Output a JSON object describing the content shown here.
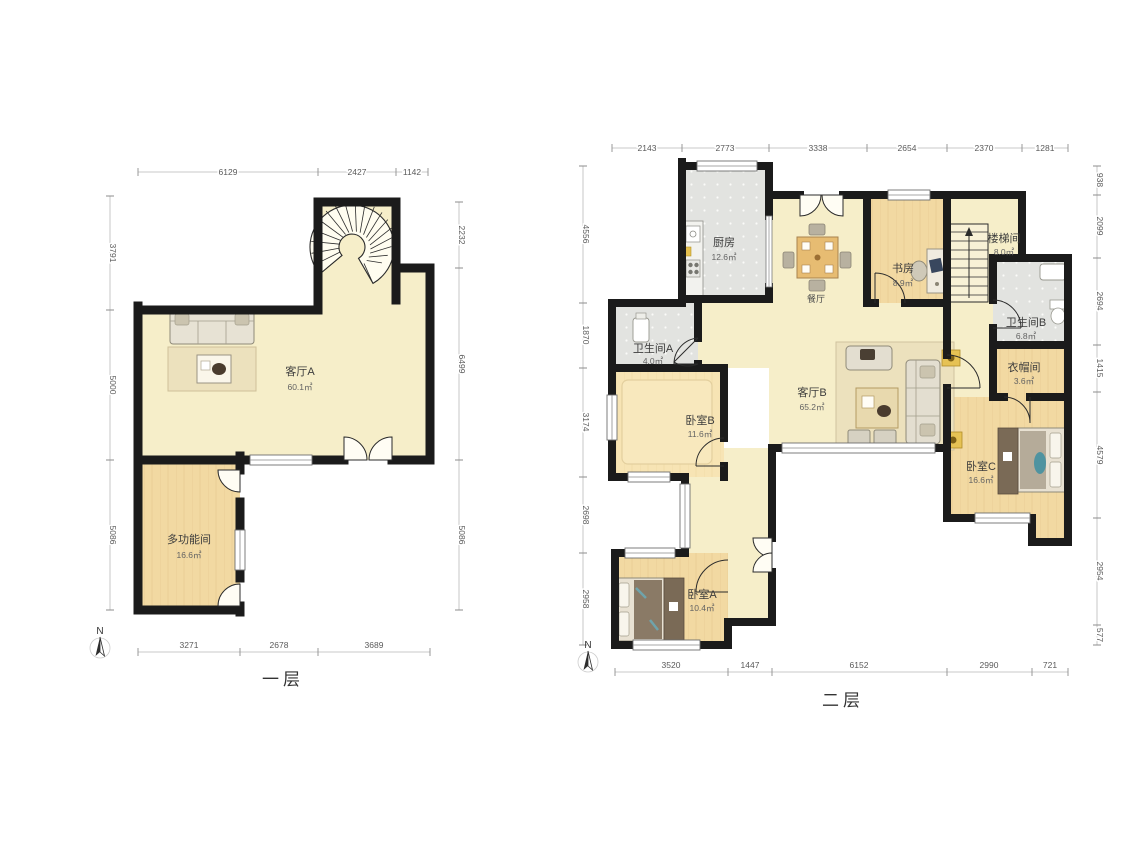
{
  "floor1": {
    "title": "一层",
    "north_label": "N",
    "rooms": {
      "living_a": {
        "name": "客厅A",
        "area": "60.1㎡"
      },
      "multi": {
        "name": "多功能间",
        "area": "16.6㎡"
      }
    },
    "dims": {
      "top": [
        "6129",
        "2427",
        "1142"
      ],
      "left": [
        "3791",
        "5000",
        "5086"
      ],
      "right": [
        "2232",
        "6499",
        "5086"
      ],
      "bottom": [
        "3271",
        "2678",
        "3689"
      ]
    }
  },
  "floor2": {
    "title": "二层",
    "north_label": "N",
    "rooms": {
      "kitchen": {
        "name": "厨房",
        "area": "12.6㎡"
      },
      "dining": {
        "name": "餐厅"
      },
      "study": {
        "name": "书房",
        "area": "8.9㎡"
      },
      "stairwell": {
        "name": "楼梯间",
        "area": "8.0㎡"
      },
      "bath_a": {
        "name": "卫生间A",
        "area": "4.0㎡"
      },
      "bath_b": {
        "name": "卫生间B",
        "area": "6.8㎡"
      },
      "cloakroom": {
        "name": "衣帽间",
        "area": "3.6㎡"
      },
      "bedroom_a": {
        "name": "卧室A",
        "area": "10.4㎡"
      },
      "bedroom_b": {
        "name": "卧室B",
        "area": "11.6㎡"
      },
      "bedroom_c": {
        "name": "卧室C",
        "area": "16.6㎡"
      },
      "living_b": {
        "name": "客厅B",
        "area": "65.2㎡"
      }
    },
    "dims": {
      "top": [
        "2143",
        "2773",
        "3338",
        "2654",
        "2370",
        "1281"
      ],
      "left": [
        "4556",
        "1870",
        "3174",
        "2698",
        "2958"
      ],
      "right": [
        "938",
        "2099",
        "2694",
        "1415",
        "4579",
        "2954",
        "577"
      ],
      "bottom": [
        "3520",
        "1447",
        "6152",
        "2990",
        "721"
      ]
    }
  },
  "colors": {
    "wall": "#1b1b1b",
    "floor_cream": "#f6eec9",
    "floor_wood": "#f2d9a2",
    "floor_wood_light": "#f7e4b4",
    "floor_tile": "#e2e3e0",
    "rug": "#ece1bd",
    "wardrobe": "#7a6a56",
    "accent_yellow": "#e6c254",
    "accent_teal": "#4f93a0"
  }
}
